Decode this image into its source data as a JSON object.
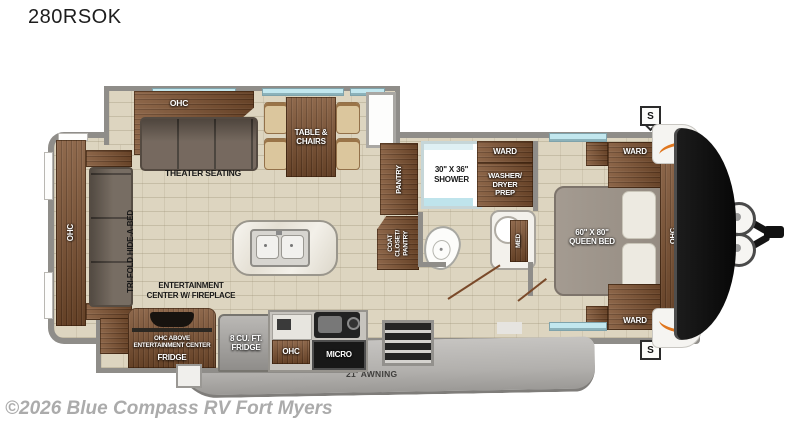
{
  "title": "280RSOK",
  "watermark": "©2026 Blue Compass RV Fort Myers",
  "colors": {
    "wall": "#8f8d89",
    "floor": "#ddd5c0",
    "wood": "#7d5130",
    "window": "#c2e7ee",
    "accent_orange": "#e0761e",
    "front_cap": "#141414",
    "awning": "#b2b0ad"
  },
  "fp": {
    "rear": {
      "ohc": "OHC",
      "sofa": "TRI-FOLD HIDE-A-BED"
    },
    "living": {
      "theater_ohc": "OHC",
      "theater": "THEATER SEATING",
      "dinette": "TABLE &\nCHAIRS"
    },
    "kitchen": {
      "ent": "ENTERTAINMENT\nCENTER W/ FIREPLACE",
      "ohc_above": "OHC ABOVE\nENTERTAINMENT CENTER",
      "fridge_word": "FRIDGE",
      "fridge8": "8 CU. FT.\nFRIDGE",
      "ohc": "OHC",
      "micro": "MICRO"
    },
    "bath": {
      "pantry": "PANTRY",
      "coat": "COAT\nCLOSET/\nPANTRY",
      "shower": "30\" X 36\"\nSHOWER",
      "ward": "WARD",
      "washer": "WASHER/\nDRYER\nPREP",
      "med": "MED"
    },
    "bedroom": {
      "bed": "60\" X 80\"\nQUEEN BED",
      "ward_top": "WARD",
      "ward_bottom": "WARD",
      "ohc": "OHC"
    },
    "exterior": {
      "awning": "21' AWNING",
      "speaker": "S",
      "brand": "Jayco"
    }
  }
}
